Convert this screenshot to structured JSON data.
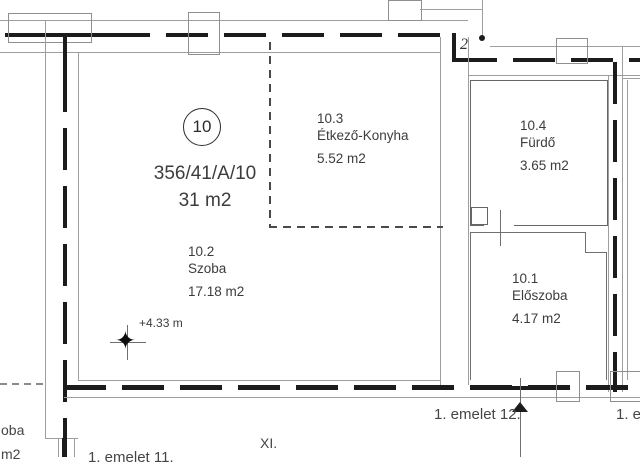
{
  "plan": {
    "unit_badge": "10",
    "lot_number": "356/41/A/10",
    "total_area": "31 m2",
    "rooms": [
      {
        "id": "10.2",
        "name": "Szoba",
        "area": "17.18 m2"
      },
      {
        "id": "10.3",
        "name": "Étkező-Konyha",
        "area": "5.52 m2"
      },
      {
        "id": "10.4",
        "name": "Fürdő",
        "area": "3.65 m2"
      },
      {
        "id": "10.1",
        "name": "Előszoba",
        "area": "4.17 m2"
      }
    ],
    "elevation_marker": "+4.33 m",
    "handwritten_note": "2",
    "labels": {
      "floor_unit_center": "1. emelet 12.",
      "floor_unit_right_partial": "1. e",
      "district": "XI.",
      "floor_unit_bottom_partial": "1. emelet 11.",
      "left_room_partial": "oba",
      "left_area_partial": "m2"
    },
    "colors": {
      "wall": "#1c1c1c",
      "thin_line": "#9e9e9e",
      "text": "#3c3c3c",
      "background": "#ffffff"
    }
  }
}
